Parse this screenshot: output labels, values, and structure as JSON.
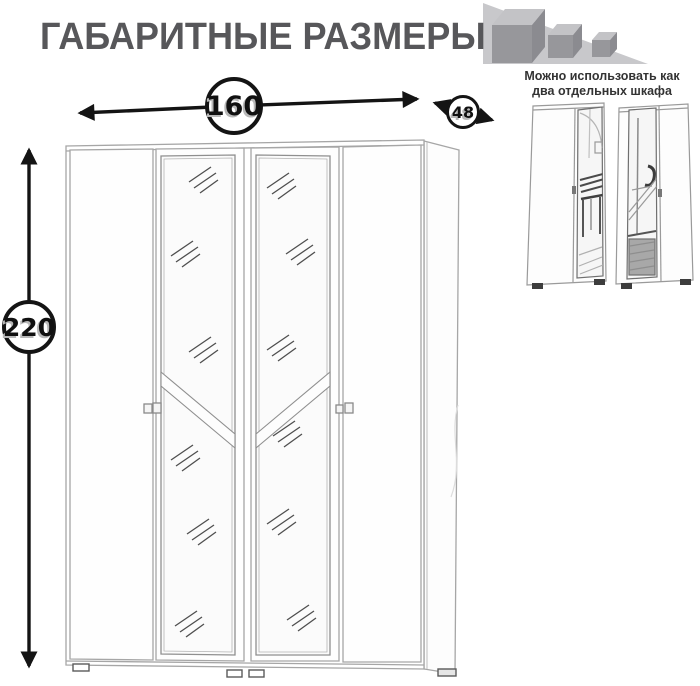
{
  "header": {
    "title": "ГАБАРИТНЫЕ РАЗМЕРЫ"
  },
  "logo": {
    "icon": "shrinking-cubes-icon"
  },
  "note": {
    "line1": "Можно использовать как",
    "line2": "два отдельных шкафа"
  },
  "dimensions": {
    "width": "160",
    "depth": "48",
    "height": "220"
  },
  "colors": {
    "title": "#57575a",
    "note_text": "#333333",
    "dimension_line": "#141414",
    "number_shadow": "#b8b8b8",
    "sketch_line": "#a6a6a6",
    "mirror_frame": "#8f8f8f",
    "shine_mark": "#4e4e4e",
    "logo_wedge": "#c8c8cb",
    "logo_cube_front": "#97979b",
    "logo_cube_top": "#c3c3c6",
    "logo_cube_side": "#8b8b90"
  }
}
